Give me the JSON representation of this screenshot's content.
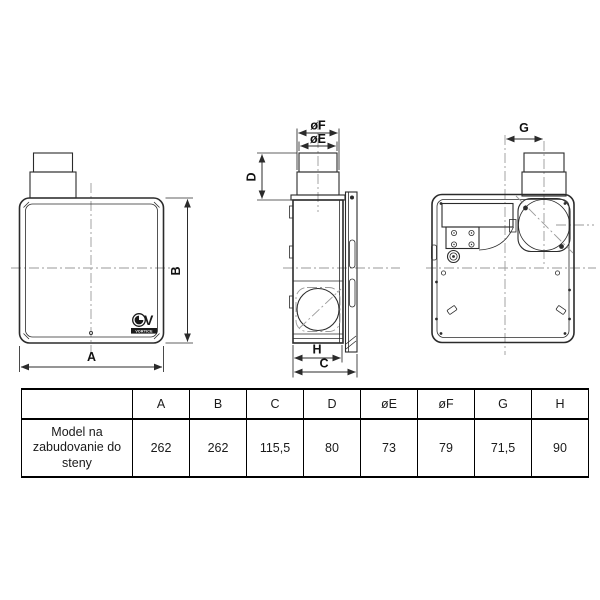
{
  "brand": {
    "logo_text": "VORTICE"
  },
  "drawings": {
    "front_view": {
      "dim_a": "A",
      "dim_b": "B"
    },
    "side_view": {
      "dim_of": "øF",
      "dim_oe": "øE",
      "dim_d": "D",
      "dim_h": "H",
      "dim_c": "C"
    },
    "rear_view": {
      "dim_g": "G"
    }
  },
  "table": {
    "headers": [
      "",
      "A",
      "B",
      "C",
      "D",
      "øE",
      "øF",
      "G",
      "H"
    ],
    "rows": [
      {
        "label": "Model na zabudovanie do steny",
        "values": [
          "262",
          "262",
          "115,5",
          "80",
          "73",
          "79",
          "71,5",
          "90"
        ]
      }
    ]
  },
  "colors": {
    "line": "#2b2b2b",
    "centerline": "#9a9a9a",
    "text": "#111111"
  }
}
